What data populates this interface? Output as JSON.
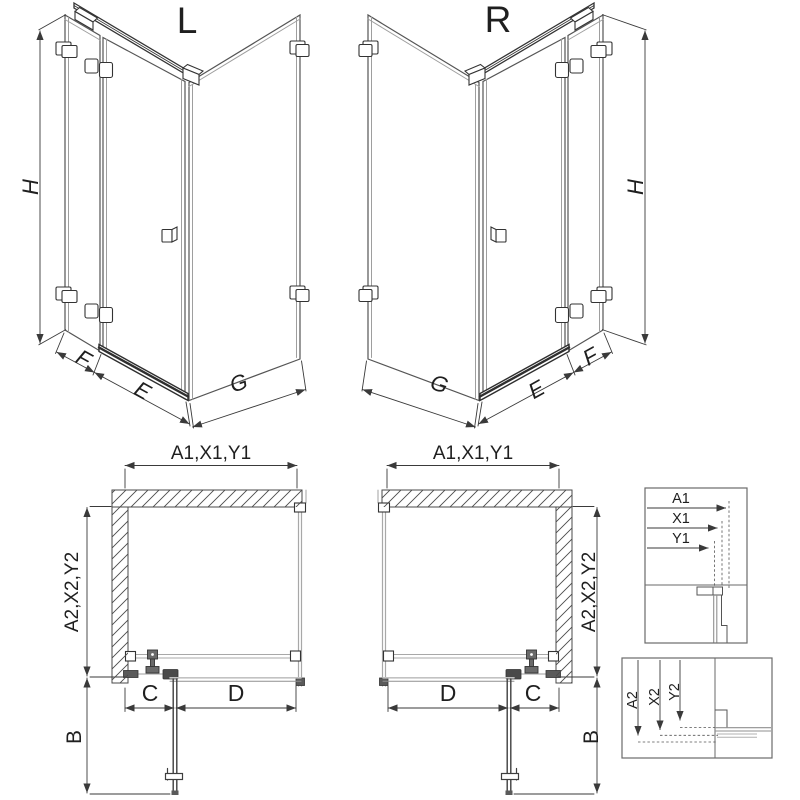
{
  "drawing": {
    "title_hint": "shower enclosure technical drawing",
    "iso_left": {
      "title": "L",
      "height": "H",
      "fixed": "F",
      "door": "E",
      "side": "G"
    },
    "iso_right": {
      "title": "R",
      "height": "H",
      "fixed": "F",
      "door": "E",
      "side": "G"
    },
    "plan_left": {
      "width": "A1,X1,Y1",
      "depth": "A2,X2,Y2",
      "fixed": "C",
      "door": "D",
      "swing": "B"
    },
    "plan_right": {
      "width": "A1,X1,Y1",
      "depth": "A2,X2,Y2",
      "fixed": "C",
      "door": "D",
      "swing": "B"
    },
    "detail_width": {
      "rows": [
        "A1",
        "X1",
        "Y1"
      ]
    },
    "detail_depth": {
      "rows": [
        "A2",
        "X2",
        "Y2"
      ]
    }
  },
  "colors": {
    "line_dark": "#3a3a3a",
    "line_gray": "#a8a8a8",
    "hatch": "#4a4a4a",
    "text": "#1f1f1f",
    "background": "#ffffff"
  }
}
